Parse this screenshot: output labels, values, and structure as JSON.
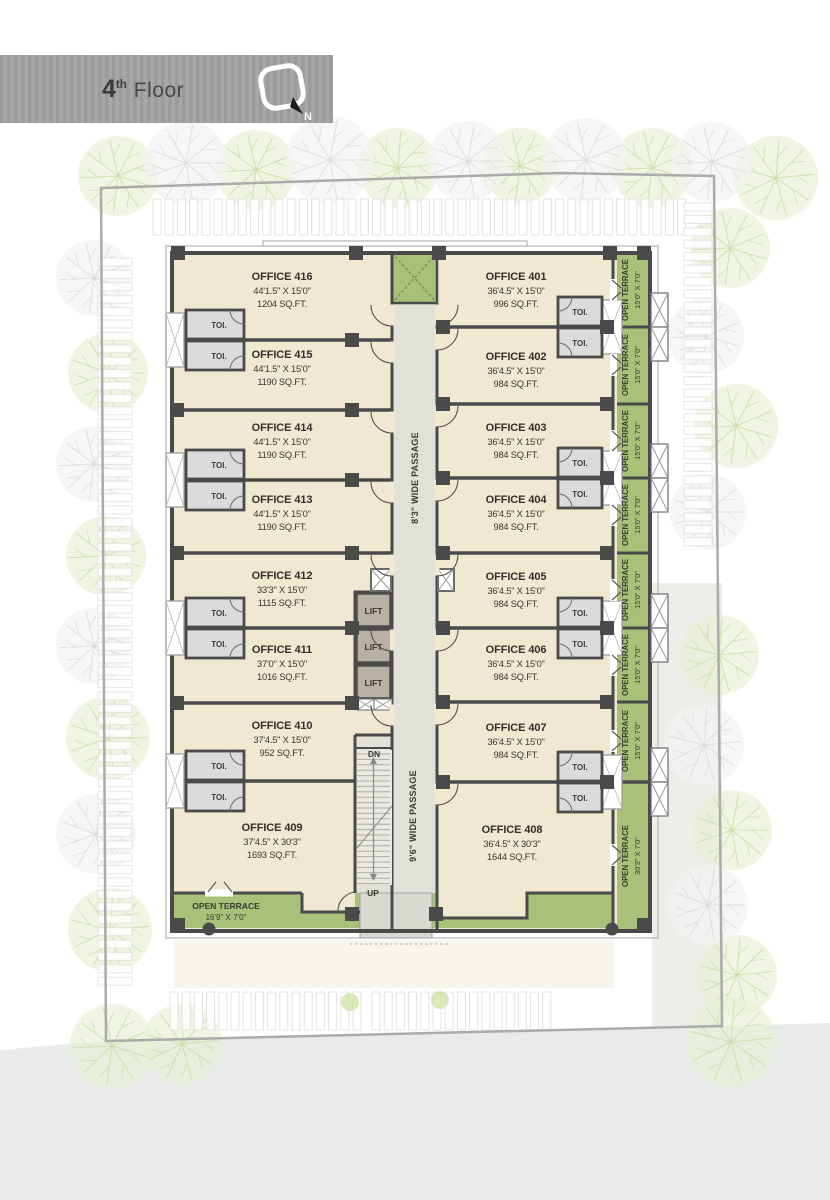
{
  "header": {
    "floor_number": "4",
    "floor_suffix": "th",
    "floor_word": "Floor",
    "north_label": "N"
  },
  "offices": [
    {
      "id": "401",
      "name": "OFFICE 401",
      "dim": "36'4.5\" X 15'0\"",
      "area": "996 SQ.FT."
    },
    {
      "id": "402",
      "name": "OFFICE 402",
      "dim": "36'4.5\" X 15'0\"",
      "area": "984 SQ.FT."
    },
    {
      "id": "403",
      "name": "OFFICE 403",
      "dim": "36'4.5\" X 15'0\"",
      "area": "984 SQ.FT."
    },
    {
      "id": "404",
      "name": "OFFICE 404",
      "dim": "36'4.5\" X 15'0\"",
      "area": "984 SQ.FT."
    },
    {
      "id": "405",
      "name": "OFFICE 405",
      "dim": "36'4.5\" X 15'0\"",
      "area": "984 SQ.FT."
    },
    {
      "id": "406",
      "name": "OFFICE 406",
      "dim": "36'4.5\" X 15'0\"",
      "area": "984 SQ.FT."
    },
    {
      "id": "407",
      "name": "OFFICE 407",
      "dim": "36'4.5\" X 15'0\"",
      "area": "984 SQ.FT."
    },
    {
      "id": "408",
      "name": "OFFICE 408",
      "dim": "36'4.5\" X 30'3\"",
      "area": "1644 SQ.FT."
    },
    {
      "id": "409",
      "name": "OFFICE 409",
      "dim": "37'4.5\" X 30'3\"",
      "area": "1693 SQ.FT."
    },
    {
      "id": "410",
      "name": "OFFICE 410",
      "dim": "37'4.5\" X 15'0\"",
      "area": "952 SQ.FT."
    },
    {
      "id": "411",
      "name": "OFFICE 411",
      "dim": "37'0\" X 15'0\"",
      "area": "1016 SQ.FT."
    },
    {
      "id": "412",
      "name": "OFFICE 412",
      "dim": "33'3\" X 15'0\"",
      "area": "1115 SQ.FT."
    },
    {
      "id": "413",
      "name": "OFFICE 413",
      "dim": "44'1.5\" X 15'0\"",
      "area": "1190 SQ.FT."
    },
    {
      "id": "414",
      "name": "OFFICE 414",
      "dim": "44'1.5\" X 15'0\"",
      "area": "1190 SQ.FT."
    },
    {
      "id": "415",
      "name": "OFFICE 415",
      "dim": "44'1.5\" X 15'0\"",
      "area": "1190 SQ.FT."
    },
    {
      "id": "416",
      "name": "OFFICE 416",
      "dim": "44'1.5\" X 15'0\"",
      "area": "1204 SQ.FT."
    }
  ],
  "passages": {
    "vertical_top": "8'3\" WIDE PASSAGE",
    "vertical_bottom": "9'6\" WIDE PASSAGE"
  },
  "stairs": {
    "down": "DN",
    "up": "UP"
  },
  "labels": {
    "lift": "LIFT",
    "toilet": "TOI."
  },
  "terraces": {
    "side_label": "OPEN TERRACE",
    "side_dim_small": "15'0\" X 7'0\"",
    "side_dim_large": "30'3\" X 7'0\"",
    "bottom_label": "OPEN TERRACE",
    "bottom_dim": "16'9\" X 7'0\""
  },
  "colors": {
    "office_floor": "#F0E8D1",
    "passage": "#E1E1D9",
    "terrace_green": "#A9C078",
    "wall": "#4A4A4A",
    "toilet": "#DBDBDB",
    "lift": "#B7B0A3",
    "banner_gray": "#A0A0A0",
    "road_gray": "#E9EAEA"
  }
}
